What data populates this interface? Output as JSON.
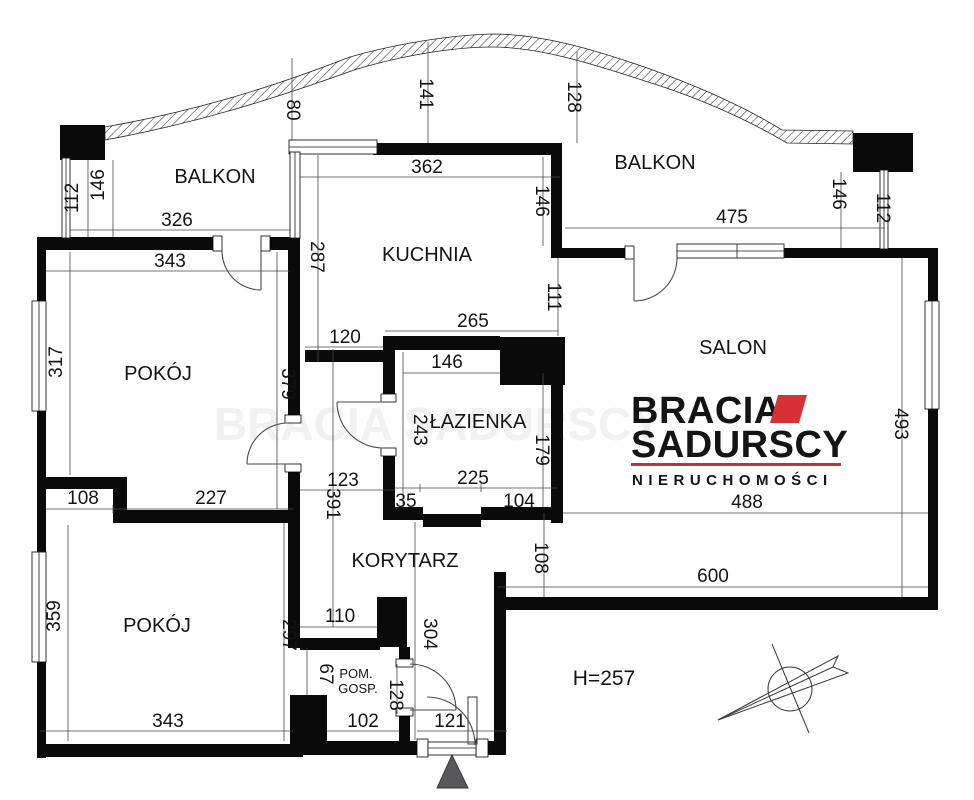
{
  "plan": {
    "rooms": {
      "balkon_left": "BALKON",
      "balkon_right": "BALKON",
      "kuchnia": "KUCHNIA",
      "pokoj_top": "POKÓJ",
      "pokoj_bottom": "POKÓJ",
      "salon": "SALON",
      "lazienka": "ŁAZIENKA",
      "korytarz": "KORYTARZ",
      "pom_gosp_line1": "POM.",
      "pom_gosp_line2": "GOSP."
    },
    "dims": {
      "balkon_left_width": "326",
      "balkon_left_112": "112",
      "balkon_left_146": "146",
      "balkon_right_width": "475",
      "balkon_right_146": "146",
      "balkon_right_112": "112",
      "top_80": "80",
      "top_141": "141",
      "top_128": "128",
      "kuchnia_width": "362",
      "kuchnia_146": "146",
      "kuchnia_287": "287",
      "kuchnia_120": "120",
      "kuchnia_111": "111",
      "pokoj_top_343": "343",
      "pokoj_top_317": "317",
      "pokoj_top_379": "379",
      "lazienka_265": "265",
      "lazienka_146": "146",
      "lazienka_243": "243",
      "lazienka_179": "179",
      "lazienka_225": "225",
      "lazienka_35": "35",
      "lazienka_104": "104",
      "salon_488": "488",
      "salon_493": "493",
      "salon_600": "600",
      "salon_108": "108",
      "korytarz_123": "123",
      "korytarz_391": "391",
      "korytarz_297": "297",
      "korytarz_304": "304",
      "korytarz_110": "110",
      "pokoj_bottom_108": "108",
      "pokoj_bottom_227": "227",
      "pokoj_bottom_359": "359",
      "pokoj_bottom_343": "343",
      "pom_gosp_67": "67",
      "pom_gosp_128": "128",
      "pom_gosp_102": "102",
      "entry_121": "121"
    },
    "height_note": "H=257"
  },
  "logo": {
    "brand_line1": "BRACIA",
    "brand_line2": "SADURSCY",
    "brand_line3": "NIERUCHOMOŚCI",
    "text_dark": "#2b2a31",
    "accent_red": "#d93036",
    "underline_red": "#b03a40"
  },
  "watermark": "BRACIA SADURSCY"
}
